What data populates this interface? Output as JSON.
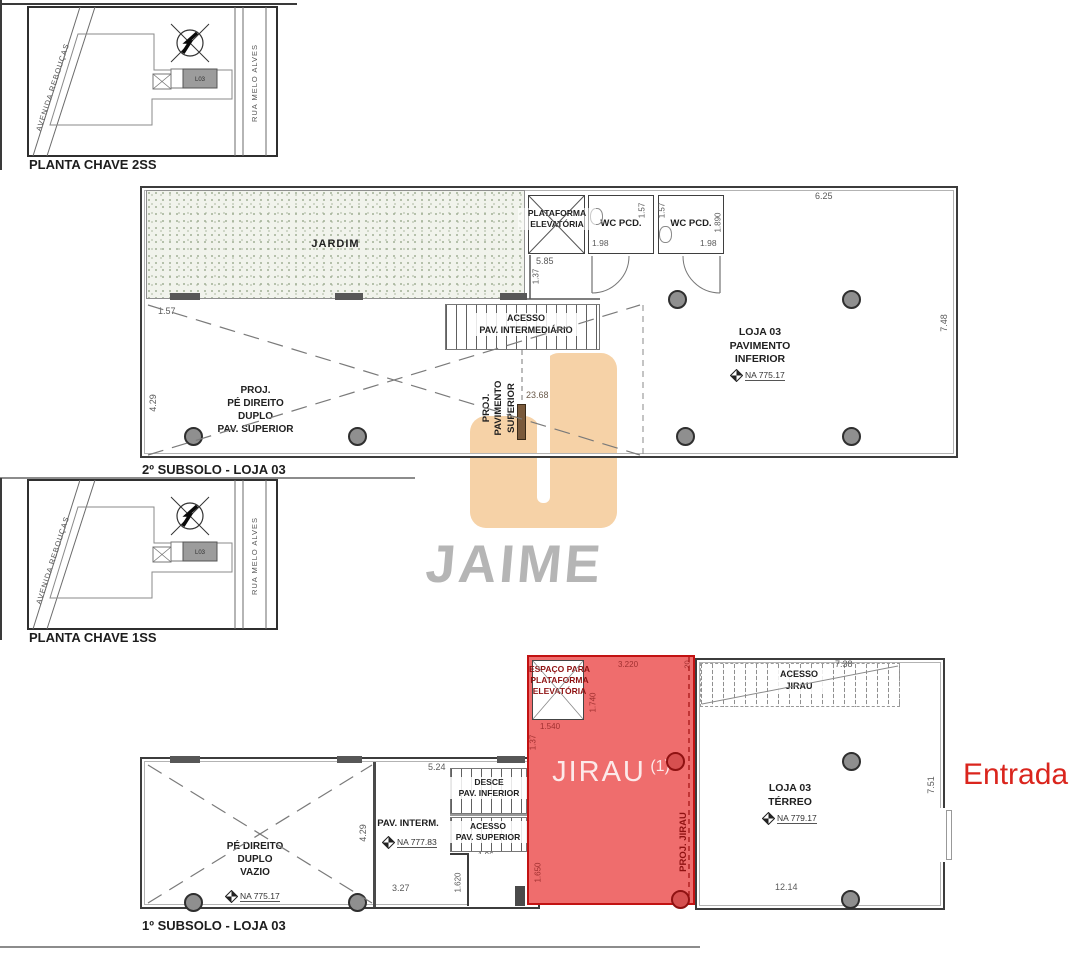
{
  "page": {
    "width": 1090,
    "height": 960,
    "background": "#ffffff"
  },
  "colors": {
    "line_dark": "#3c3c3c",
    "jirau_fill": "#ef6d6d",
    "jirau_border": "#c21212",
    "dark_red_text": "#8f1212",
    "logo_orange": "#f6d2a7",
    "watermark_gray": "#b5b5b5",
    "entrada_red": "#da251d",
    "column_gray": "#8f8f8f"
  },
  "keyplans": [
    {
      "title": "PLANTA CHAVE 2SS",
      "street_diagonal": "AVENIDA REBOUÇAS",
      "street_vertical": "RUA MELO ALVES",
      "lot": "L03"
    },
    {
      "title": "PLANTA CHAVE 1SS",
      "street_diagonal": "AVENIDA REBOUÇAS",
      "street_vertical": "RUA MELO ALVES",
      "lot": "L03"
    }
  ],
  "watermark": {
    "brand": "JAIME"
  },
  "plan2ss": {
    "title": "2º SUBSOLO - LOJA 03",
    "rooms": {
      "jardim": "JARDIM",
      "plataforma": "PLATAFORMA\nELEVATÓRIA",
      "wc1": "WC PCD.",
      "wc2": "WC PCD.",
      "acesso_intermediario": "ACESSO\nPAV. INTERMEDIÁRIO",
      "loja_inferior": "LOJA 03\nPAVIMENTO\nINFERIOR",
      "na_loja_inferior": "NA  775.17",
      "proj_pe_direito": "PROJ.\nPÉ DIREITO\nDUPLO\nPAV. SUPERIOR",
      "proj_pav_superior": "PROJ.\nPAVIMENTO\nSUPERIOR"
    },
    "dims": {
      "top": "6.25",
      "right": "7.48",
      "wc1_width": "1.98",
      "wc2_width": "1.98",
      "wc1_depth": "1.57",
      "wc2_depth": "1.57",
      "plataforma_front": "5.85",
      "wall_right": "1.890",
      "corridor": "1.37",
      "jardim_edge": "1.57",
      "left_height": "4.29",
      "proj_extent": "23.68"
    }
  },
  "plan1ss": {
    "title": "1º SUBSOLO - LOJA 03",
    "rooms": {
      "espaco_plataforma": "ESPAÇO PARA\nPLATAFORMA\nELEVATÓRIA",
      "jirau": "JIRAU",
      "jirau_sup": "(1)",
      "proj_jirau": "PROJ. JIRAU",
      "acesso_jirau": "ACESSO\nJIRAU",
      "loja_terreo": "LOJA 03\nTÉRREO",
      "na_loja_terreo": "NA  779.17",
      "pav_interm": "PAV. INTERM.",
      "na_pav_interm": "NA  777.83",
      "desce": "DESCE\nPAV. INFERIOR",
      "acesso_superior": "ACESSO\nPAV. SUPERIOR",
      "stair_run": "1.96",
      "pe_direito": "PÉ DIREITO\nDUPLO\nVAZIO",
      "na_pe_direito": "NA  775.17"
    },
    "dims": {
      "espaco_width": "3.220",
      "wall_top": "20",
      "espaco_depth": "1.740",
      "espaco_inner": "1.540",
      "espaco_left": "1.37",
      "stairs_top": "7.38",
      "right": "7.51",
      "bottom": "12.14",
      "interm_top": "5.24",
      "left_height": "4.29",
      "interm_bottom": "3.27",
      "stair_width": "1.620",
      "jirau_left": "1.650"
    }
  },
  "entrada": "Entrada"
}
